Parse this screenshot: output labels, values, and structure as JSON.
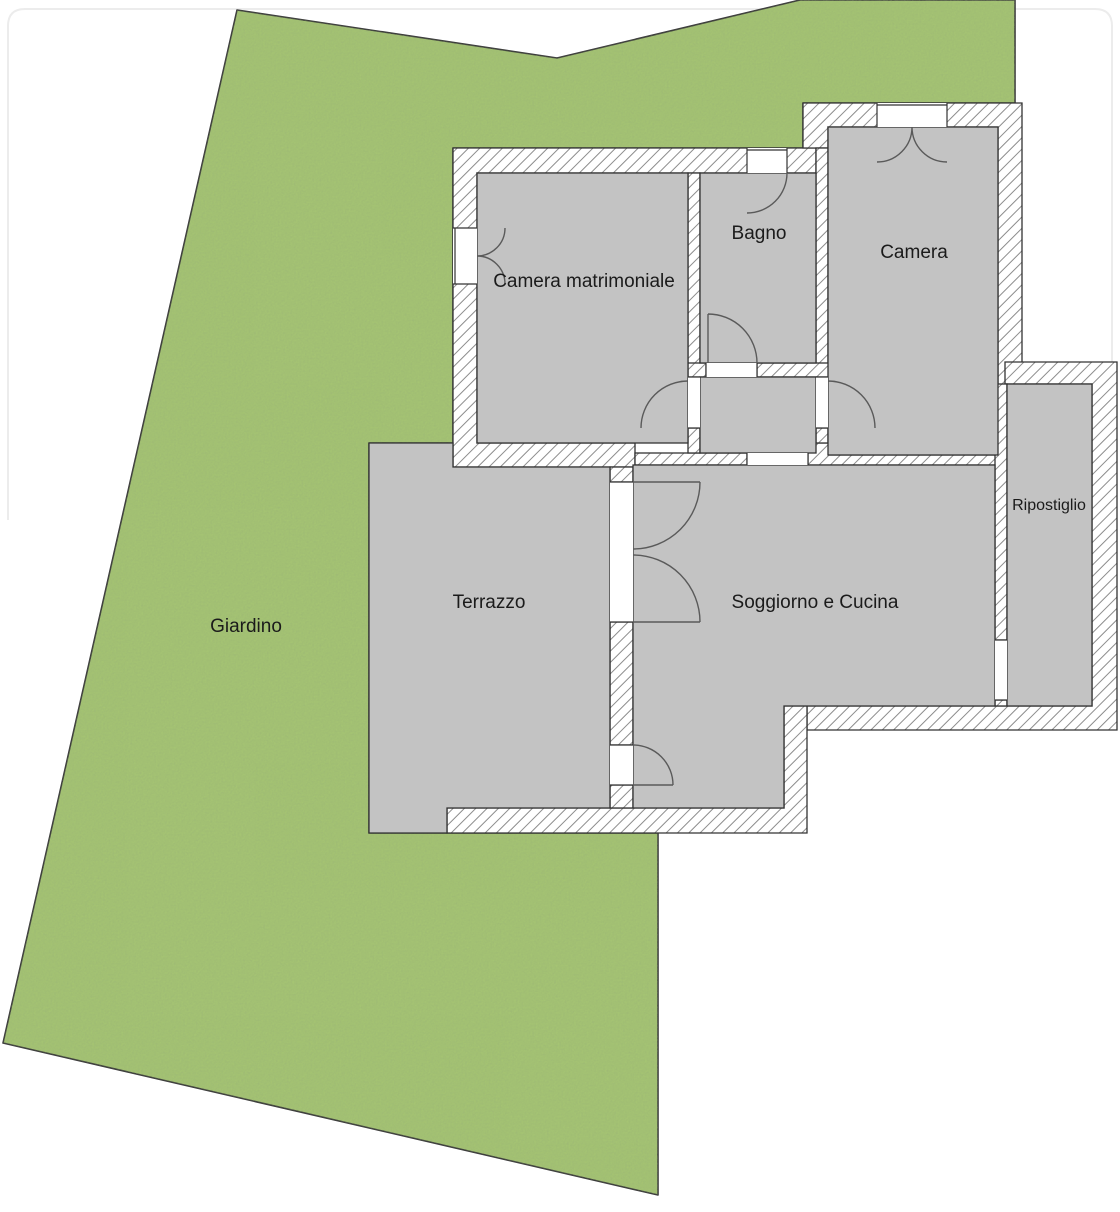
{
  "title": "Planimetria appartamento con giardino",
  "colors": {
    "background": "#ffffff",
    "garden": "#a5c473",
    "garden_edge": "#3a3a3a",
    "floor": "#c3c3c3",
    "wall_fill": "#ffffff",
    "hatch": "#8c8c8c",
    "outline": "#333333",
    "door": "#5a5a5a",
    "text": "#1b1b1b",
    "frame": "#ececec"
  },
  "rooms": [
    {
      "id": "giardino",
      "label": "Giardino"
    },
    {
      "id": "camera-matrimoniale",
      "label": "Camera matrimoniale"
    },
    {
      "id": "bagno",
      "label": "Bagno"
    },
    {
      "id": "camera",
      "label": "Camera"
    },
    {
      "id": "ripostiglio",
      "label": "Ripostiglio"
    },
    {
      "id": "terrazzo",
      "label": "Terrazzo"
    },
    {
      "id": "soggiorno",
      "label": "Soggiorno e Cucina"
    }
  ]
}
